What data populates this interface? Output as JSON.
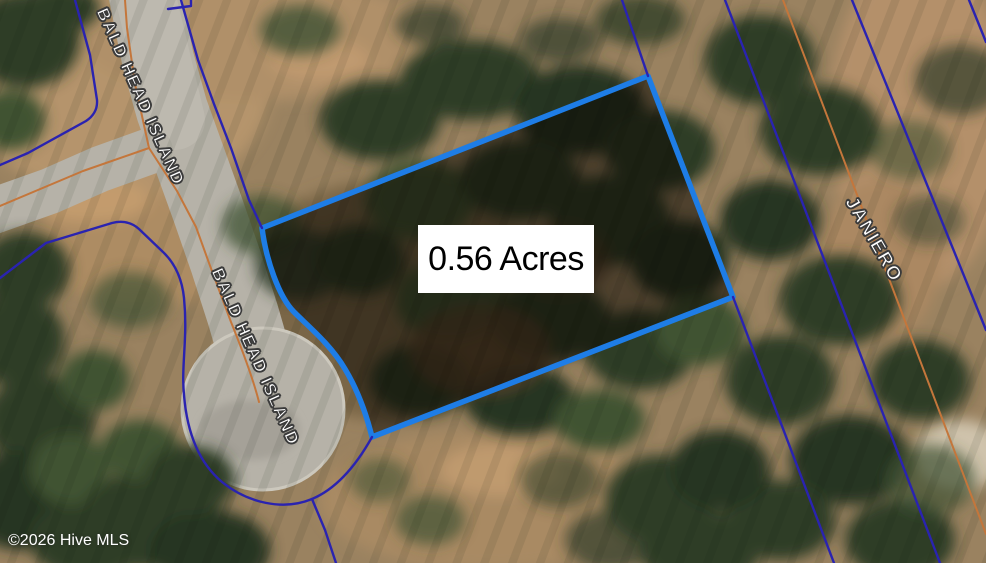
{
  "map": {
    "acreage_label": "0.56 Acres",
    "streets": [
      {
        "name": "BALD HEAD ISLAND"
      },
      {
        "name": "BALD HEAD ISLAND"
      },
      {
        "name": "JANIERO"
      }
    ],
    "copyright": "©2026 Hive MLS",
    "colors": {
      "subject_parcel_outline": "#1e7de6",
      "parcel_boundary": "#2a23b0",
      "road_centerline": "#c4763b",
      "acreage_box_bg": "#ffffff",
      "acreage_text": "#000000",
      "street_label_text": "#ffffff"
    }
  }
}
